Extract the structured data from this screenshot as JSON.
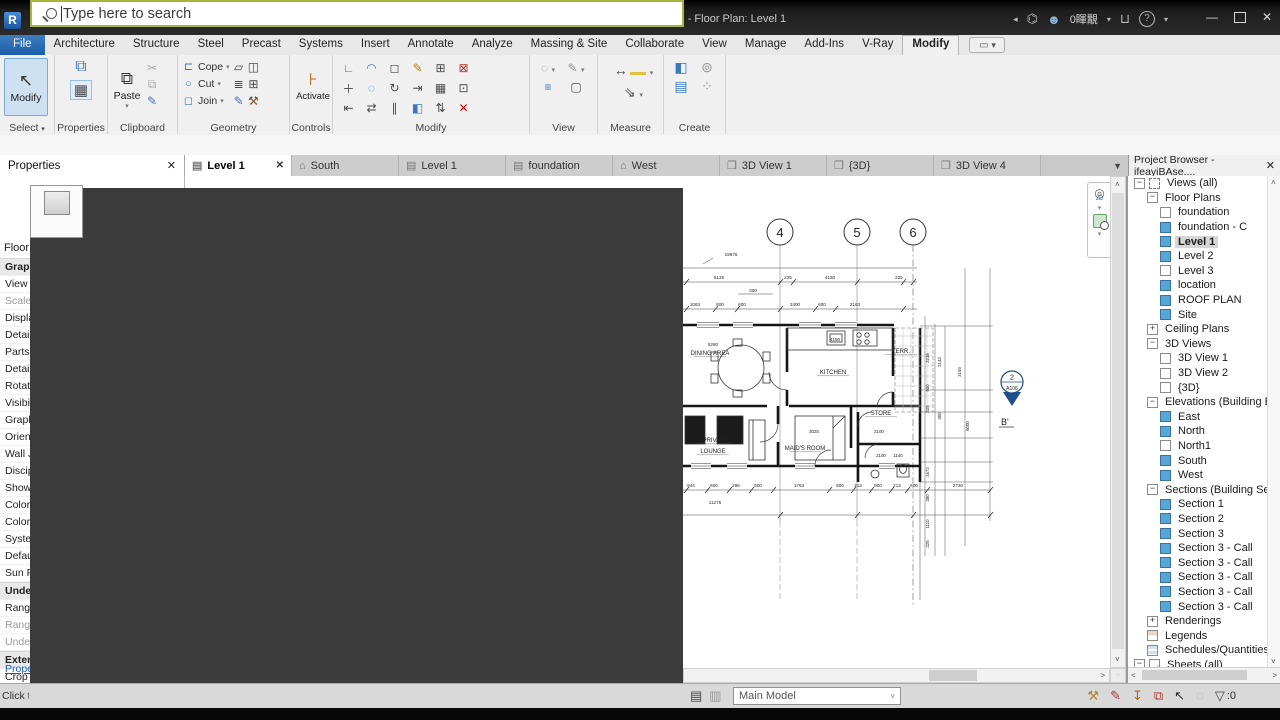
{
  "titlebar": {
    "title": "Autodesk Revit 2023 - ifeayiBAse.0016 - Floor Plan: Level 1",
    "user_name": "0睴覯",
    "qat": [
      {
        "name": "app-logo",
        "glyph": "R",
        "cls": "app"
      },
      {
        "name": "ui-window",
        "glyph": "▣"
      },
      {
        "name": "open-file",
        "glyph": "▱"
      },
      {
        "name": "save-file",
        "glyph": "◫"
      },
      {
        "name": "sync-center",
        "glyph": "⟳"
      },
      {
        "name": "sync-caret",
        "glyph": "▾",
        "cls": "caret"
      },
      {
        "name": "undo",
        "glyph": "↶"
      },
      {
        "name": "undo-caret",
        "glyph": "▾",
        "cls": "caret"
      },
      {
        "name": "redo",
        "glyph": "↷"
      },
      {
        "name": "redo-caret",
        "glyph": "▾",
        "cls": "caret"
      },
      {
        "name": "print",
        "glyph": "▤"
      },
      {
        "name": "export-pdf",
        "glyph": "▥",
        "cls": "pdf"
      },
      {
        "name": "measure",
        "glyph": "⊶"
      },
      {
        "name": "aligned-dimension",
        "glyph": "↔",
        "cls": "dim"
      },
      {
        "name": "dimension-caret",
        "glyph": "▾",
        "cls": "caret"
      },
      {
        "name": "model-line",
        "glyph": "╱"
      },
      {
        "name": "tag",
        "glyph": "◎"
      },
      {
        "name": "text-note",
        "glyph": "A"
      },
      {
        "name": "default-3d-view",
        "glyph": "◧"
      },
      {
        "name": "view-caret",
        "glyph": "▾",
        "cls": "caret"
      },
      {
        "name": "section",
        "glyph": "◇"
      },
      {
        "name": "thin-lines",
        "glyph": "≣"
      },
      {
        "name": "close-hidden-windows",
        "glyph": "⊠"
      },
      {
        "name": "switch-windows",
        "glyph": "❏"
      },
      {
        "name": "switch-caret",
        "glyph": "▾",
        "cls": "caret"
      },
      {
        "name": "customize-qat",
        "glyph": "▾",
        "cls": "caret"
      }
    ],
    "window_buttons": {
      "minimize": "—",
      "close": "✕"
    }
  },
  "ribbon": {
    "tabs": [
      "File",
      "Architecture",
      "Structure",
      "Steel",
      "Precast",
      "Systems",
      "Insert",
      "Annotate",
      "Analyze",
      "Massing & Site",
      "Collaborate",
      "View",
      "Manage",
      "Add-Ins",
      "V-Ray",
      "Modify"
    ],
    "active_tab": "Modify",
    "panels": {
      "select": "Select",
      "select_caret": "▾",
      "properties": "Properties",
      "clipboard": "Clipboard",
      "geometry": "Geometry",
      "controls": "Controls",
      "modify": "Modify",
      "view": "View",
      "measure": "Measure",
      "create": "Create"
    },
    "buttons": {
      "modify": "Modify",
      "paste": "Paste",
      "cope": "Cope",
      "cut": "Cut",
      "join": "Join",
      "activate": "Activate"
    },
    "modify_icons": [
      {
        "g": "∟",
        "c": "#3a78c2"
      },
      {
        "g": "◠",
        "c": "#3a78c2"
      },
      {
        "g": "◻",
        "c": "#4a4a4a"
      },
      {
        "g": "✎",
        "c": "#b8860b"
      },
      {
        "g": "⊞",
        "c": "#4a4a4a"
      },
      {
        "g": "⊠",
        "c": "#b33"
      },
      {
        "g": "＋",
        "c": "#4a4a4a"
      },
      {
        "g": "◌",
        "c": "#3a78c2"
      },
      {
        "g": "↻",
        "c": "#4a4a4a"
      },
      {
        "g": "⇥",
        "c": "#4a4a4a"
      },
      {
        "g": "▦",
        "c": "#4a4a4a"
      },
      {
        "g": "⊡",
        "c": "#4a4a4a"
      },
      {
        "g": "⇤",
        "c": "#4a4a4a"
      },
      {
        "g": "⇄",
        "c": "#4a4a4a"
      },
      {
        "g": "∥",
        "c": "#4a4a4a"
      },
      {
        "g": "◧",
        "c": "#3a78c2"
      },
      {
        "g": "⇅",
        "c": "#4a4a4a"
      },
      {
        "g": "✕",
        "c": "#c00"
      }
    ]
  },
  "view_tabs": [
    {
      "label": "Level 1",
      "icon": "plan",
      "active": true
    },
    {
      "label": "South",
      "icon": "elev"
    },
    {
      "label": "Level 1",
      "icon": "plan"
    },
    {
      "label": "foundation",
      "icon": "plan"
    },
    {
      "label": "West",
      "icon": "elev"
    },
    {
      "label": "3D View 1",
      "icon": "3d"
    },
    {
      "label": "{3D}",
      "icon": "3d"
    },
    {
      "label": "3D View 4",
      "icon": "3d"
    }
  ],
  "properties_panel": {
    "title": "Properties",
    "type_row": "Floor Plan",
    "rows": [
      {
        "label": "Graphics",
        "type": "header"
      },
      {
        "label": "View Scale"
      },
      {
        "label": "Scale Value 1:",
        "gray": true
      },
      {
        "label": "Display Model"
      },
      {
        "label": "Detail Level"
      },
      {
        "label": "Parts Visibility"
      },
      {
        "label": "Detail Number"
      },
      {
        "label": "Rotation on Sheet"
      },
      {
        "label": "Visibility/Graphics"
      },
      {
        "label": "Graphic Display Opti"
      },
      {
        "label": "Orientation"
      },
      {
        "label": "Wall Join Display"
      },
      {
        "label": "Discipline"
      },
      {
        "label": "Show Hidden Lines"
      },
      {
        "label": "Color Scheme Locati"
      },
      {
        "label": "Color Scheme"
      },
      {
        "label": "System Color Schem"
      },
      {
        "label": "Default Analysis Dis"
      },
      {
        "label": "Sun Path"
      },
      {
        "label": "Underlay",
        "type": "header"
      },
      {
        "label": "Range: Base Level"
      },
      {
        "label": "Range: Top Level",
        "gray": true
      },
      {
        "label": "Underlay Orientatio",
        "gray": true
      },
      {
        "label": "Extents",
        "type": "header"
      },
      {
        "label": "Crop View"
      },
      {
        "label": "Crop Region Visible"
      }
    ],
    "help_link": "Properties help"
  },
  "project_browser": {
    "title": "Project Browser - ifeayiBAse....",
    "items": [
      {
        "label": "Views (all)",
        "level": 0,
        "expand": "-",
        "icon": "views"
      },
      {
        "label": "Floor Plans",
        "level": 1,
        "expand": "-"
      },
      {
        "label": "foundation",
        "level": 2,
        "icon": "white"
      },
      {
        "label": "foundation - C",
        "level": 2,
        "icon": "blue"
      },
      {
        "label": "Level 1",
        "level": 2,
        "icon": "blue",
        "selected": true
      },
      {
        "label": "Level 2",
        "level": 2,
        "icon": "blue"
      },
      {
        "label": "Level 3",
        "level": 2,
        "icon": "white"
      },
      {
        "label": "location",
        "level": 2,
        "icon": "blue"
      },
      {
        "label": "ROOF PLAN",
        "level": 2,
        "icon": "blue"
      },
      {
        "label": "Site",
        "level": 2,
        "icon": "blue"
      },
      {
        "label": "Ceiling Plans",
        "level": 1,
        "expand": "+"
      },
      {
        "label": "3D Views",
        "level": 1,
        "expand": "-"
      },
      {
        "label": "3D View 1",
        "level": 2,
        "icon": "white"
      },
      {
        "label": "3D View 2",
        "level": 2,
        "icon": "white"
      },
      {
        "label": "{3D}",
        "level": 2,
        "icon": "white"
      },
      {
        "label": "Elevations (Building E",
        "level": 1,
        "expand": "-"
      },
      {
        "label": "East",
        "level": 2,
        "icon": "blue"
      },
      {
        "label": "North",
        "level": 2,
        "icon": "blue"
      },
      {
        "label": "North1",
        "level": 2,
        "icon": "white"
      },
      {
        "label": "South",
        "level": 2,
        "icon": "blue"
      },
      {
        "label": "West",
        "level": 2,
        "icon": "blue"
      },
      {
        "label": "Sections (Building Sec",
        "level": 1,
        "expand": "-"
      },
      {
        "label": "Section 1",
        "level": 2,
        "icon": "blue"
      },
      {
        "label": "Section 2",
        "level": 2,
        "icon": "blue"
      },
      {
        "label": "Section 3",
        "level": 2,
        "icon": "blue"
      },
      {
        "label": "Section 3 - Call",
        "level": 2,
        "icon": "blue"
      },
      {
        "label": "Section 3 - Call",
        "level": 2,
        "icon": "blue"
      },
      {
        "label": "Section 3 - Call",
        "level": 2,
        "icon": "blue"
      },
      {
        "label": "Section 3 - Call",
        "level": 2,
        "icon": "blue"
      },
      {
        "label": "Section 3 - Call",
        "level": 2,
        "icon": "blue"
      },
      {
        "label": "Renderings",
        "level": 1,
        "expand": "+"
      },
      {
        "label": "Legends",
        "level": 1,
        "icon": "legend"
      },
      {
        "label": "Schedules/Quantities (",
        "level": 1,
        "icon": "schedule"
      },
      {
        "label": "Sheets (all)",
        "level": 0,
        "expand": "-",
        "icon": "sheet"
      }
    ]
  },
  "status_bar": {
    "hint": "Click to select",
    "search_placeholder": "Type here to search",
    "main_model": "Main Model",
    "filter_count": ":0",
    "icons": [
      {
        "name": "worksets-status",
        "glyph": "⚒",
        "c": "#b08a2e"
      },
      {
        "name": "exclude-options",
        "glyph": "✎",
        "c": "#b33939"
      },
      {
        "name": "press-drag",
        "glyph": "↧",
        "c": "#b06a1a"
      },
      {
        "name": "manage-links",
        "glyph": "⧉",
        "c": "#b33939"
      },
      {
        "name": "select-toggle",
        "glyph": "↖",
        "c": "#333333"
      },
      {
        "name": "background-processes",
        "glyph": "◌",
        "c": "#aaaaaa"
      }
    ]
  },
  "plan": {
    "grids": [
      "4",
      "5",
      "6"
    ],
    "rooms": [
      "DINING AREA",
      "KITCHEN",
      "TERR.",
      "PRIVATE",
      "LOUNGE",
      "MAID'S ROOM",
      "STORE"
    ],
    "dims_top": [
      "19675",
      "5125",
      "225",
      "4150",
      "225",
      "300",
      "1063",
      "600",
      "600",
      "2400",
      "600",
      "2163",
      "5260",
      "4150"
    ],
    "dims_bottom": [
      "944",
      "600",
      "296",
      "600",
      "1763",
      "600",
      "213",
      "900",
      "213",
      "600",
      "2730",
      "11275"
    ],
    "dims_right": [
      "2218",
      "500",
      "225",
      "1672",
      "350",
      "1110",
      "225",
      "2143",
      "300",
      "3193",
      "6000",
      "3025",
      "2100",
      "2100",
      "1140"
    ],
    "section_marker": {
      "num": "2",
      "sheet": "A106",
      "tag": "B'"
    }
  }
}
